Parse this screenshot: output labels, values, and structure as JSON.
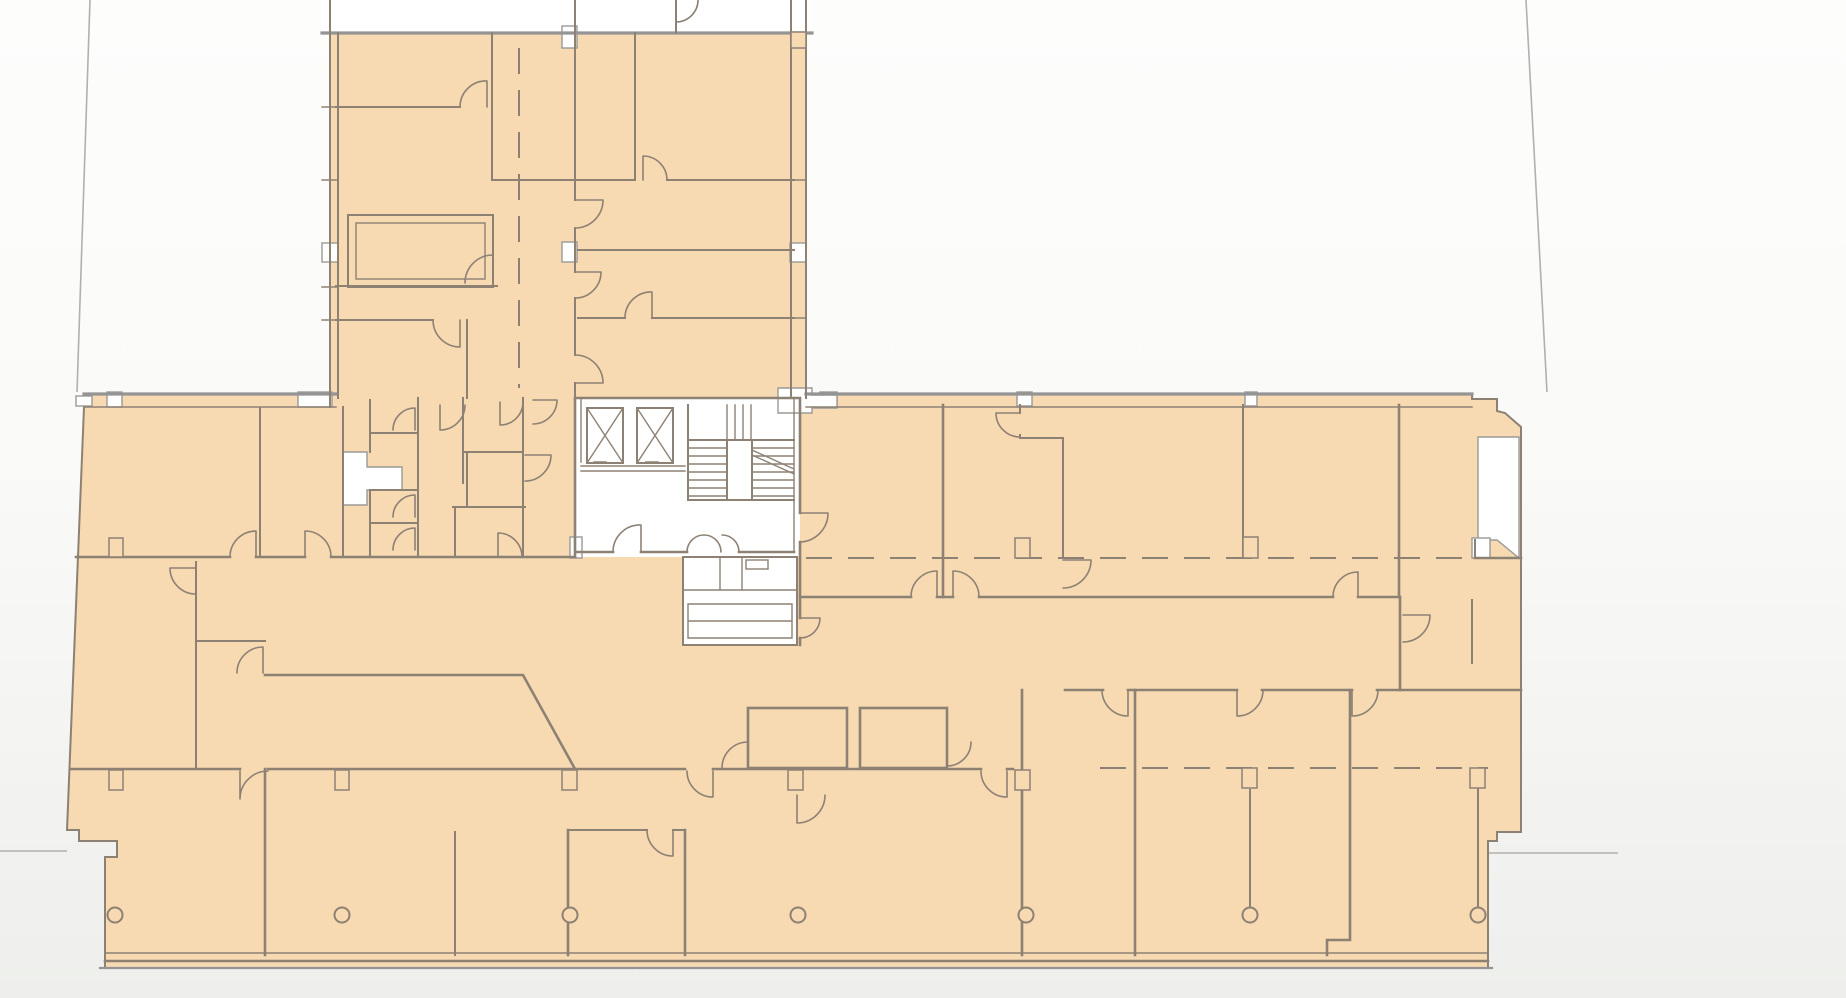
{
  "meta": {
    "view": "architectural-floor-plan",
    "visible_text": "",
    "description_of_pixels": "storey plan with tinted tenancy area, elevator and stair core, door swings, structural column row"
  },
  "colors": {
    "unit_fill": "#f7d9b2",
    "room_white": "#ffffff",
    "wall": "#8d8174",
    "wall_heavy": "#949494",
    "thin_line": "#b3b0aa",
    "white_stroke": "#9a9a96"
  },
  "structure": {
    "elevator_shafts": 2,
    "stair_flights": 2,
    "column_row_y": 915,
    "column_radius": 7.5,
    "column_xs": [
      115,
      342,
      570,
      798,
      1026,
      1250,
      1478
    ],
    "tread_ys": [
      448,
      456,
      464,
      472,
      480,
      488,
      496
    ],
    "upper_flight_xs": [
      727,
      735,
      743,
      751
    ]
  }
}
